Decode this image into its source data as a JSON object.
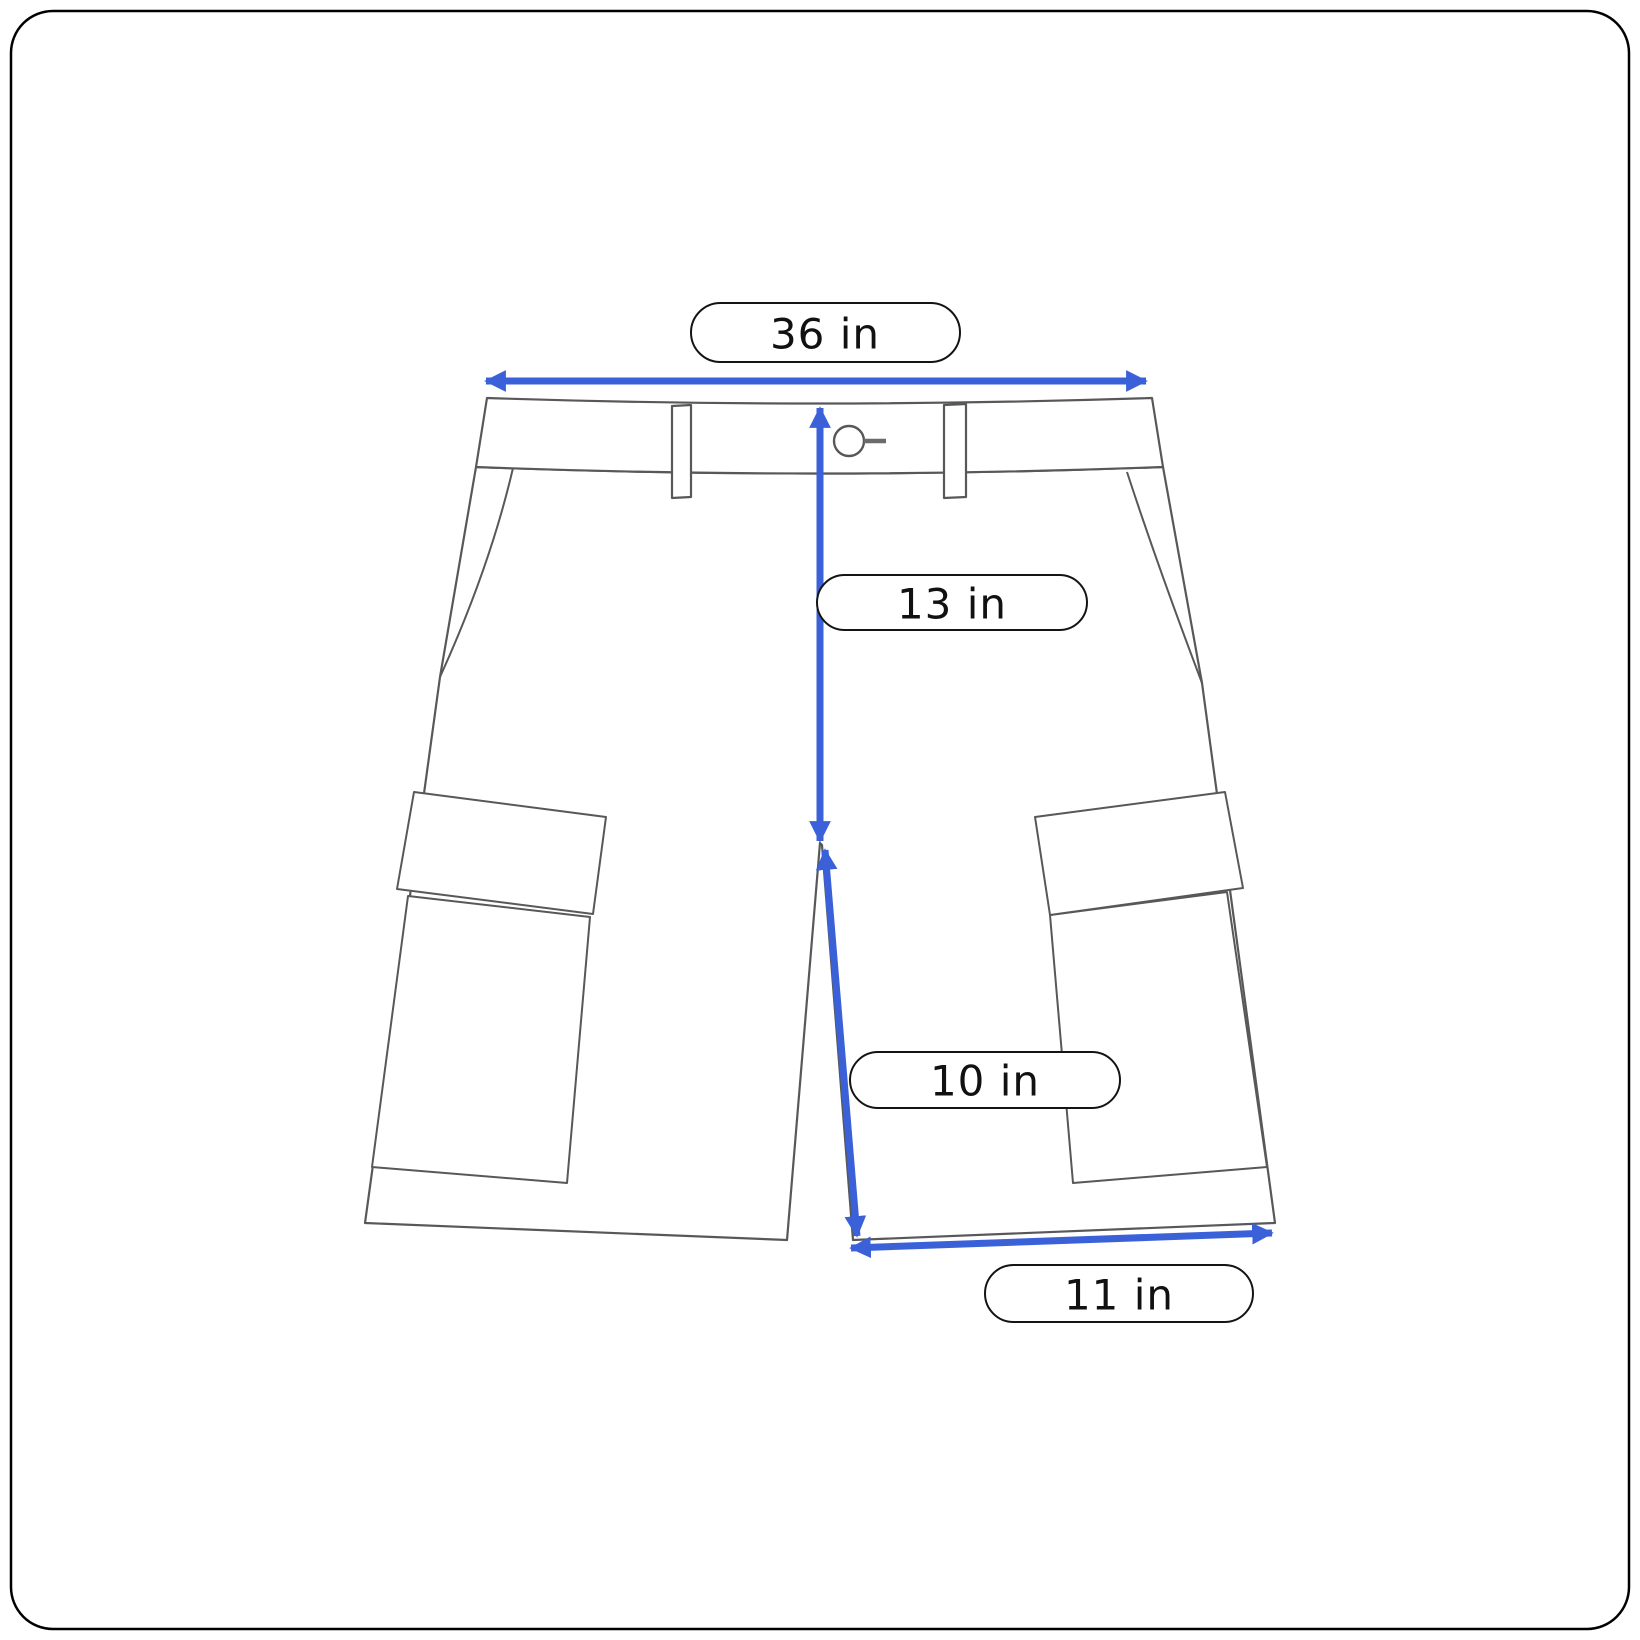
{
  "diagram": {
    "measurements": {
      "waist": {
        "label": "36 in"
      },
      "front_rise": {
        "label": "13 in"
      },
      "inseam": {
        "label": "10 in"
      },
      "leg_opening": {
        "label": "11 in"
      }
    },
    "colors": {
      "arrow": "#3B61D9",
      "garment_outline": "#58585A",
      "buttonhole": "#6B6B6B",
      "label_border": "#141414",
      "label_text": "#111111",
      "frame_border": "#000000",
      "background": "#FFFFFF"
    }
  }
}
